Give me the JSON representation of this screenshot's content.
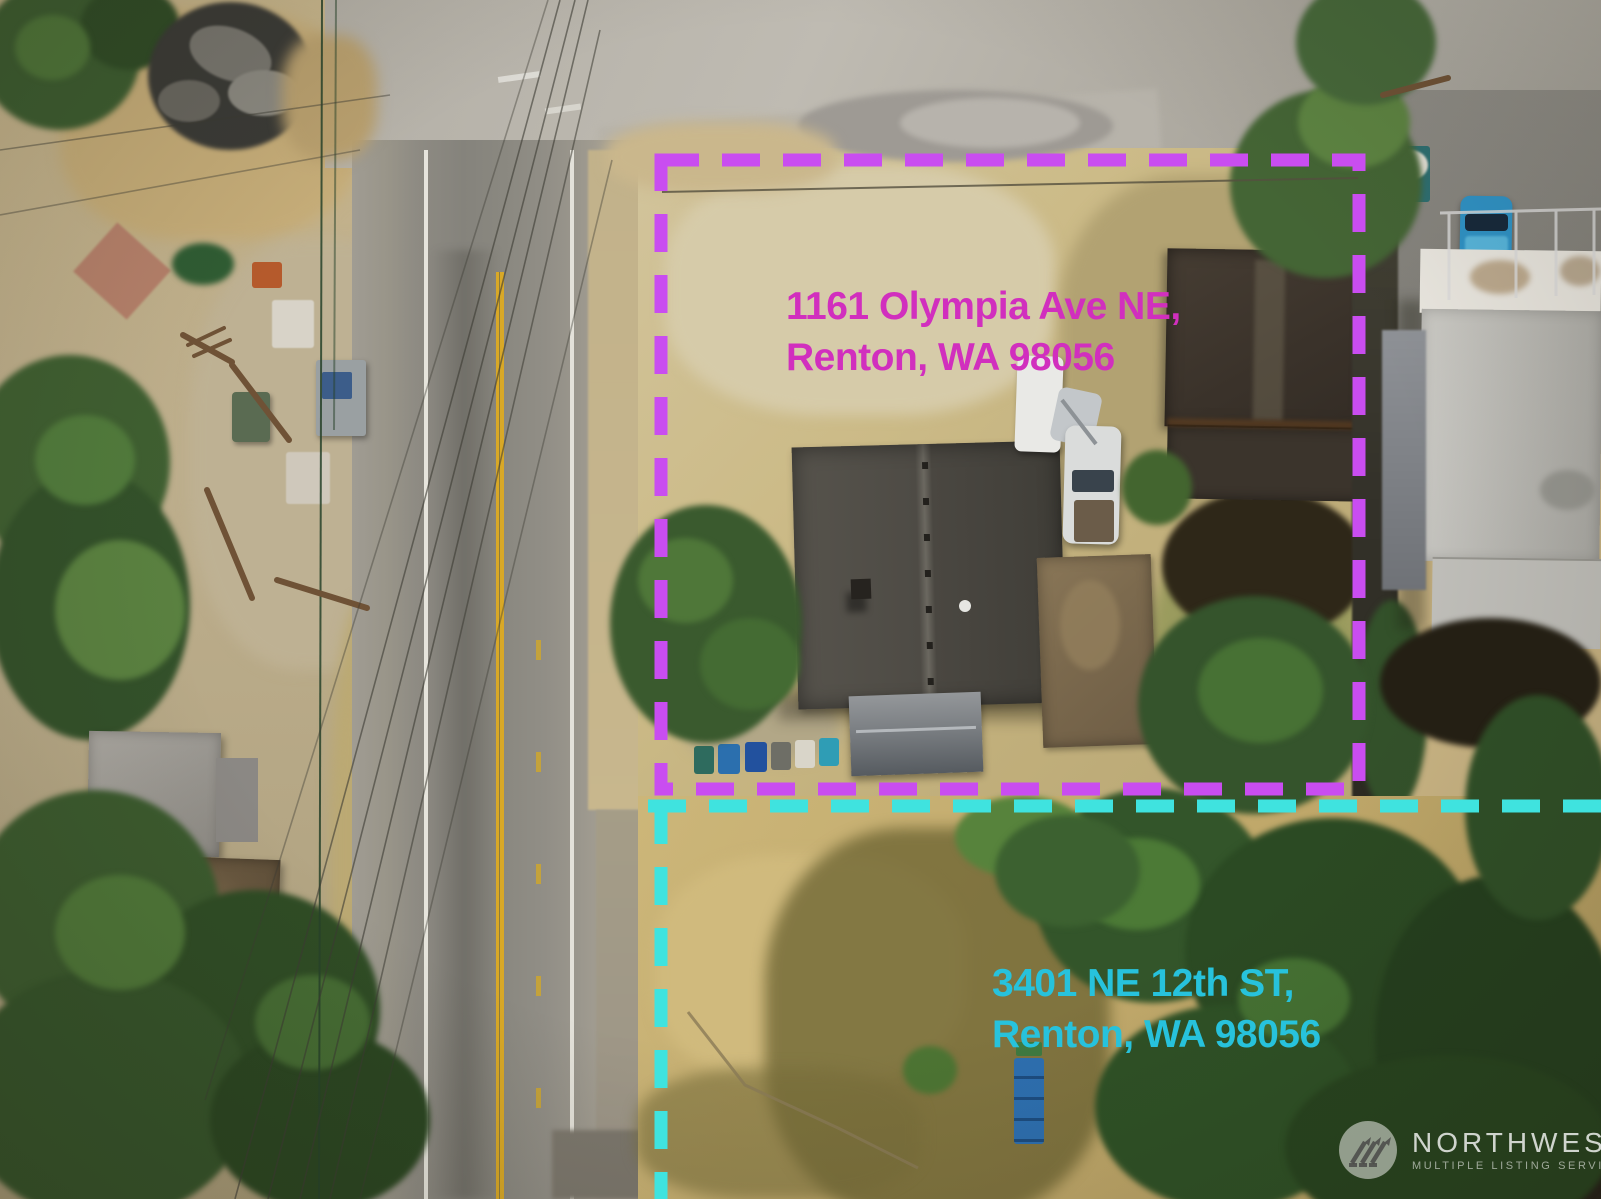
{
  "labels": {
    "property1": {
      "line1": "1161 Olympia Ave NE,",
      "line2": "Renton, WA 98056"
    },
    "property2": {
      "line1": "3401 NE 12th ST,",
      "line2": "Renton, WA 98056"
    }
  },
  "watermark": {
    "brand": "NORTHWEST",
    "tagline": "MULTIPLE LISTING SERVICE"
  },
  "colors": {
    "magenta_text": "#d12fbe",
    "magenta_dash": "#c94df0",
    "cyan_text": "#27c2dc",
    "cyan_dash": "#3fe3df"
  }
}
